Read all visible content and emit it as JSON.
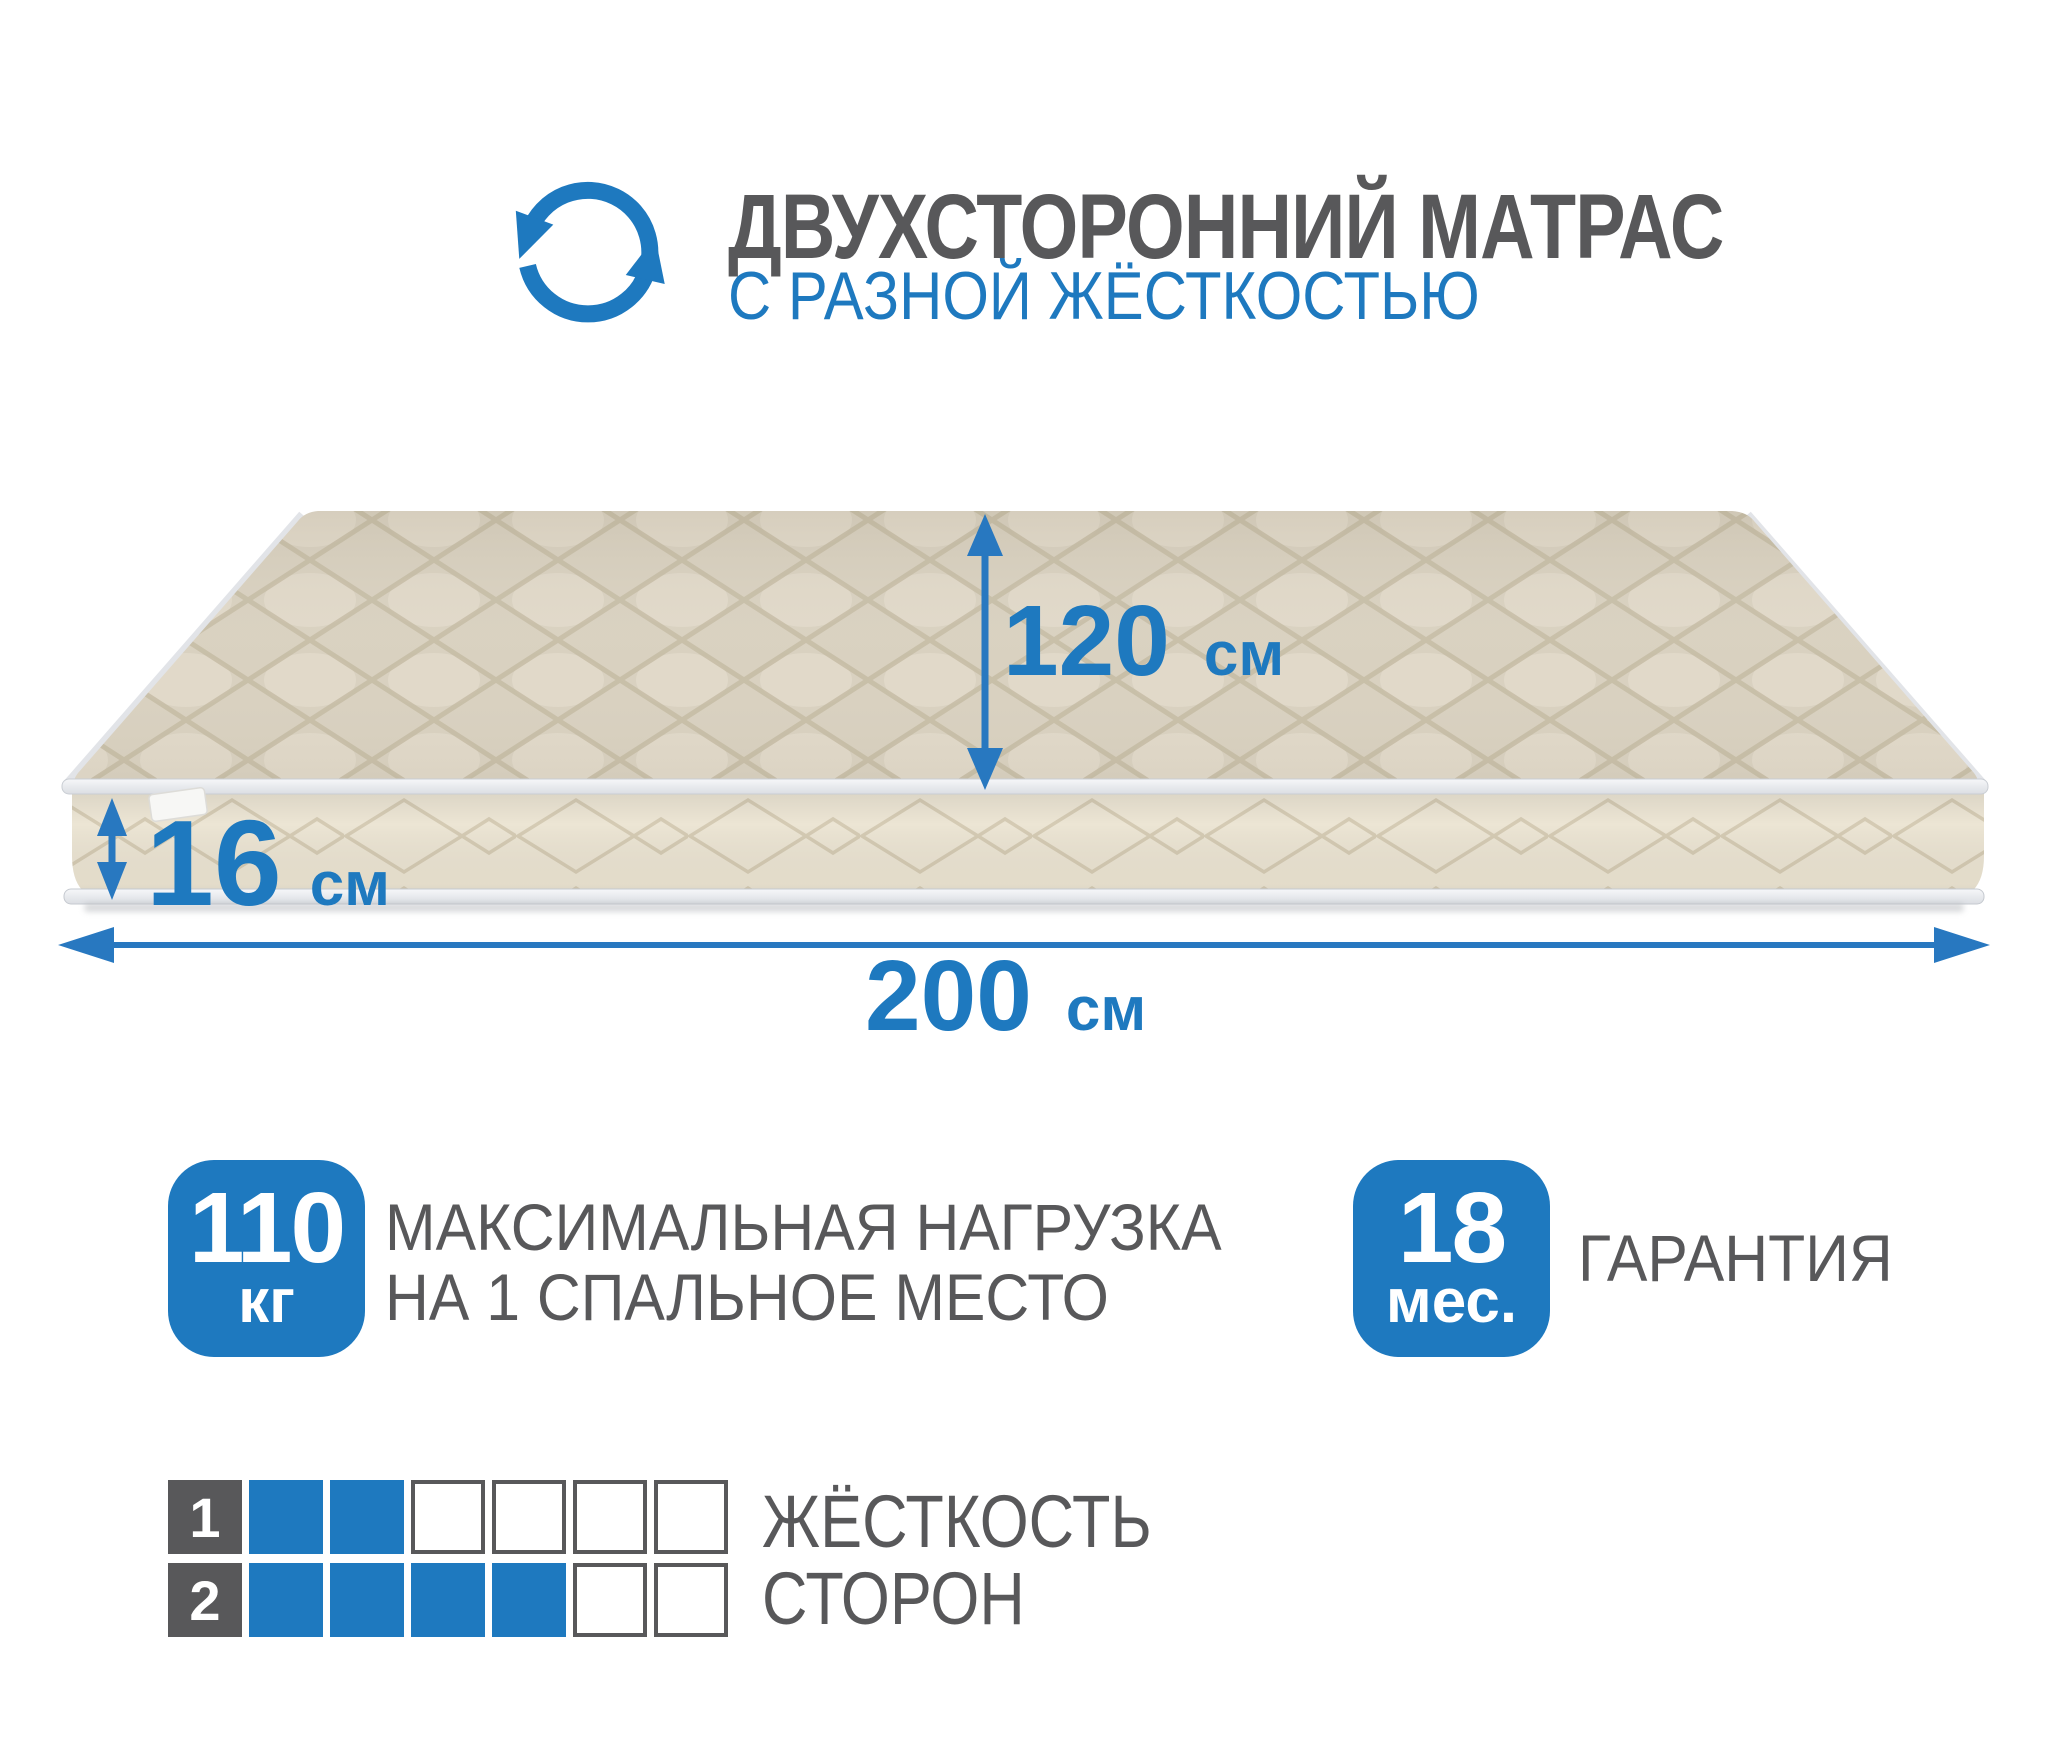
{
  "colors": {
    "accent_blue": "#1e79bf",
    "dark_gray_text": "#58585a",
    "mattress_top": "#d9d1c0",
    "mattress_side": "#ece5d4",
    "piping_white": "#eef0f3"
  },
  "header": {
    "icon": "rotate-arrows-icon",
    "title": "ДВУХСТОРОННИЙ МАТРАС",
    "subtitle": "С РАЗНОЙ ЖЁСТКОСТЬЮ"
  },
  "diagram": {
    "dimensions": {
      "width": {
        "value": "120",
        "unit": "см"
      },
      "thickness": {
        "value": "16",
        "unit": "см"
      },
      "length": {
        "value": "200",
        "unit": "см"
      }
    }
  },
  "features": [
    {
      "badge_value": "110",
      "badge_unit": "кг",
      "label_lines": [
        "МАКСИМАЛЬНАЯ НАГРУЗКА",
        "НА 1 СПАЛЬНОЕ МЕСТО"
      ]
    },
    {
      "badge_value": "18",
      "badge_unit": "мес.",
      "label_lines": [
        "ГАРАНТИЯ"
      ]
    }
  ],
  "firmness": {
    "label_lines": [
      "ЖЁСТКОСТЬ",
      "СТОРОН"
    ],
    "rows": [
      {
        "side": "1",
        "filled": 2,
        "total": 6
      },
      {
        "side": "2",
        "filled": 4,
        "total": 6
      }
    ]
  }
}
